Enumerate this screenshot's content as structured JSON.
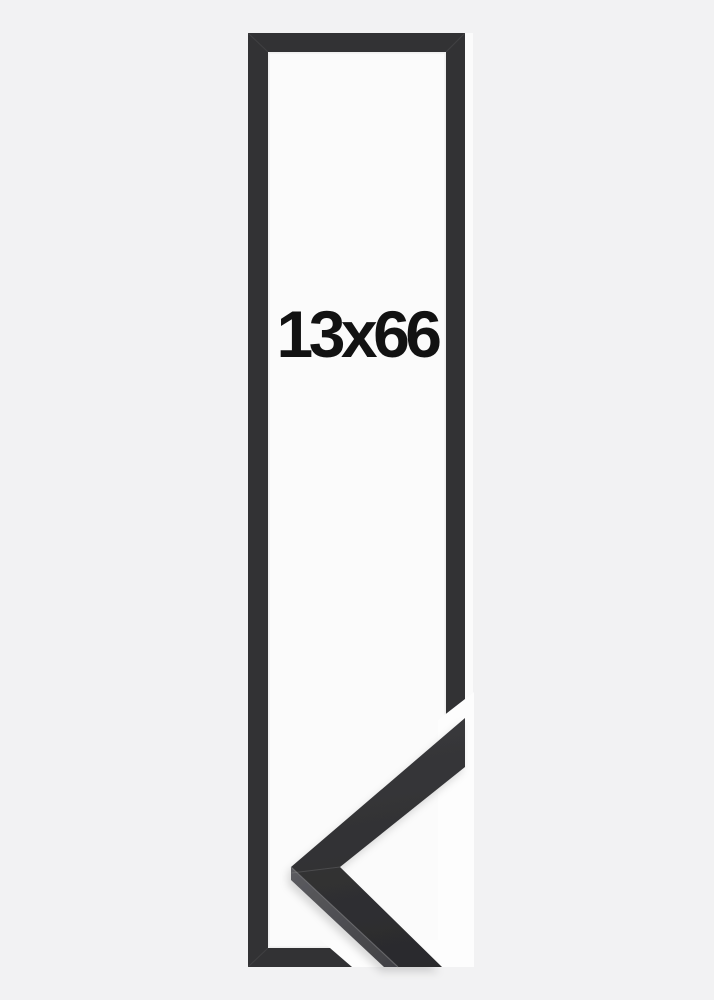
{
  "product_image": {
    "size_label": "13x66",
    "subject": "black-picture-frame-with-corner-profile-sample"
  },
  "colors": {
    "page_background": "#f2f2f3",
    "photo_background": "#fbfbfb",
    "gap_white": "#fdfdfd",
    "frame": "#323234",
    "label_text": "#121212",
    "moulding_face_start": "#3a3a3d",
    "moulding_face_end": "#2a2a2c",
    "moulding_side_start": "#5a5a5e",
    "moulding_side_end": "#404044",
    "arris_highlight": "#7c7c80",
    "miter_seam": "#9a9a9a"
  }
}
